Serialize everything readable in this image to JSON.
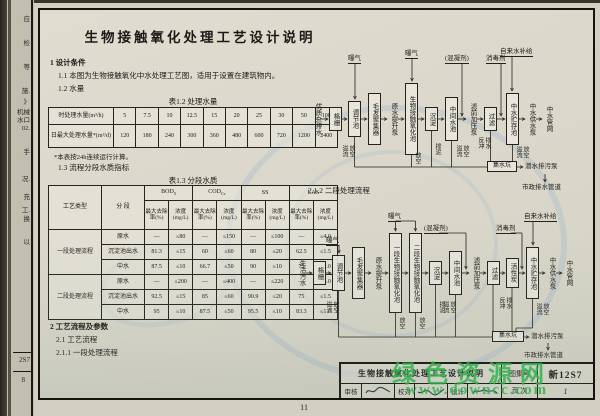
{
  "page": {
    "title": "生物接触氧化处理工艺设计说明",
    "page_number": "11"
  },
  "left_strip": {
    "fragments": [
      "应",
      "检",
      "等",
      "施.",
      "》",
      "机械",
      "水口",
      "02.",
      "手",
      "况.",
      "充",
      "工.",
      "换",
      "以"
    ],
    "atlas_no": "2S7",
    "page_no": "8"
  },
  "sections": {
    "s1": "1 设计条件",
    "s1_1": "1.1 本图为生物接触氧化中水处理工艺图，适用于设置在建筑物内。",
    "s1_2": "1.2 水量",
    "t12_caption": "表1.2  处理水量",
    "t12_note": "*本表按24h连续运行计算。",
    "s1_3": "1.3 流程分段水质指标",
    "t13_caption": "表1.3  分段水质",
    "s2": "2 工艺流程及参数",
    "s2_1": "2.1 工艺流程",
    "s2_1_1": "2.1.1 一段处理流程"
  },
  "table12": {
    "row1_label": "时处理水量(m³/h)",
    "row1": [
      "5",
      "7.5",
      "10",
      "12.5",
      "15",
      "20",
      "25",
      "30",
      "50",
      "100"
    ],
    "row2_label": "日最大处理水量*(m³/d)",
    "row2": [
      "120",
      "180",
      "240",
      "300",
      "360",
      "480",
      "600",
      "720",
      "1200",
      "2400"
    ]
  },
  "table13": {
    "col1": "工艺类型",
    "col2": "分 段",
    "params": [
      {
        "m": "BOD",
        "s": "5"
      },
      {
        "m": "COD",
        "s": "Cr"
      },
      {
        "m": "SS",
        "s": ""
      },
      {
        "m": "LAS",
        "s": ""
      }
    ],
    "sub_removal": "最大去除率(%)",
    "sub_conc": "浓度(mg/L)",
    "groups": [
      {
        "type": "一段处理流程",
        "rows": [
          {
            "stage": "原水",
            "vals": [
              "—",
              "≤80",
              "—",
              "≤150",
              "—",
              "≤100",
              "—",
              "≤4.0"
            ]
          },
          {
            "stage": "沉淀池出水",
            "vals": [
              "81.3",
              "≤15",
              "60",
              "≤60",
              "80",
              "≤20",
              "62.5",
              "≤1.5"
            ]
          },
          {
            "stage": "中水",
            "vals": [
              "87.5",
              "≤10",
              "66.7",
              "≤50",
              "90",
              "≤10",
              "75",
              "≤1.0"
            ]
          }
        ]
      },
      {
        "type": "二段处理流程",
        "rows": [
          {
            "stage": "原水",
            "vals": [
              "—",
              "≤200",
              "—",
              "≤400",
              "—",
              "≤220",
              "—",
              "≤6.0"
            ]
          },
          {
            "stage": "沉淀池出水",
            "vals": [
              "92.5",
              "≤15",
              "85",
              "≤60",
              "90.9",
              "≤20",
              "75",
              "≤1.5"
            ]
          },
          {
            "stage": "中水",
            "vals": [
              "95",
              "≤10",
              "87.5",
              "≤50",
              "95.5",
              "≤10",
              "83.3",
              "≤1.0"
            ]
          }
        ]
      }
    ]
  },
  "d1": {
    "src": "优质杂排水",
    "grid": "格栅",
    "reg": "调节池",
    "hair": "毛发聚集器",
    "pump1": "原水提升泵",
    "bio": "生物接触氧化池",
    "sed": "沉淀",
    "mid": "中间水池",
    "pump2": "滤前加压泵",
    "filter": "过滤",
    "store": "中水贮存池",
    "pump3": "中水供水泵",
    "net": "中水管网",
    "aer1": "曝气",
    "aer2": "曝气",
    "coag": "(混凝剂)",
    "disf": "消毒剂",
    "tap": "自来水补给",
    "ovf1": "溢流放空",
    "fk": "放空",
    "sludge": "排泥",
    "ovf2": "溢流放空",
    "backwash": "反冲排水",
    "ovf3": "溢流放空",
    "sump": "集水坑",
    "sewpump": "潜水排污泵",
    "municipal": "市政排水管道"
  },
  "d2": {
    "heading": "2.1.2 二段处理流程",
    "src": "生活污水",
    "grid": "格栅",
    "reg": "调节池",
    "hair": "毛发聚集器",
    "pump1": "原水提升泵",
    "bio1": "一段生物接触氧化池",
    "bio2": "二段生物接触氧化池",
    "sed": "沉淀",
    "mid": "中间水池",
    "pump2": "滤前加压泵",
    "filter": "过滤",
    "carbon": "活性炭",
    "store": "中水贮存池",
    "pump3": "中水供水泵",
    "net": "中水管网",
    "aer1": "曝气",
    "aer2": "曝气",
    "coag": "(混凝剂)",
    "disf": "消毒剂",
    "tap": "自来水补给",
    "ovf1": "溢流放空",
    "fk1": "放空",
    "fk2": "放空",
    "sludge": "排泥",
    "ovf2": "溢流放空",
    "backwash": "反冲排水",
    "ovf3": "溢流放空",
    "sump": "集水坑",
    "sewpump": "潜水排污泵",
    "municipal": "市政排水管道"
  },
  "titleblock": {
    "title": "生物接触氧化处理工艺设计说明",
    "atlas_label": "图集号",
    "atlas_no": "新12S7",
    "review": "审核",
    "check": "校对",
    "design": "设计",
    "page_label": "页 次",
    "page_no": "1"
  },
  "watermark": {
    "site": "绿色资源网",
    "url": "www.downcc.com"
  }
}
